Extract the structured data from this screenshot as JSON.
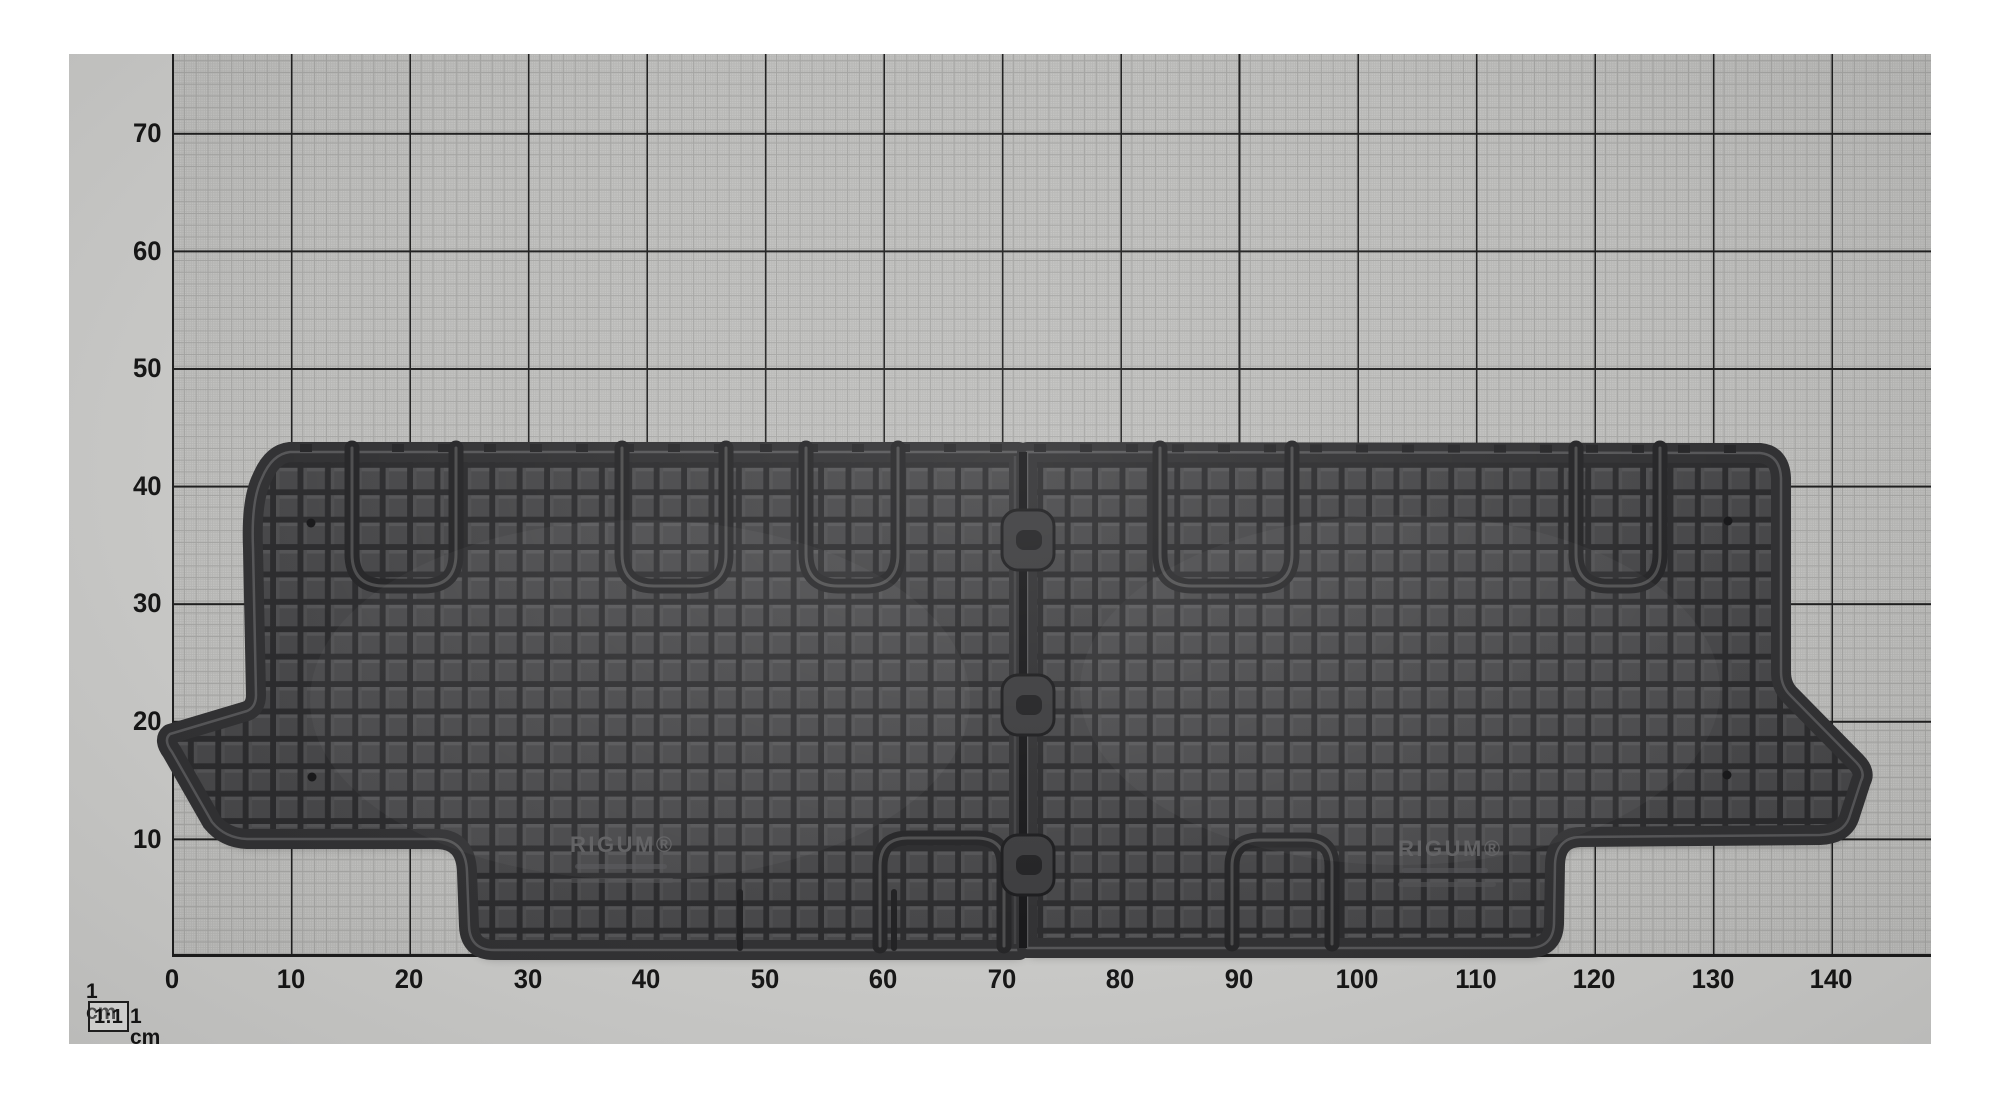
{
  "meta": {
    "description": "Black rubber third-row car floor mat (two hinged pieces) photographed on 1 cm measuring grid paper",
    "brand": "RIGUM®"
  },
  "ruler": {
    "x_axis_labels": [
      "0",
      "10",
      "20",
      "30",
      "40",
      "50",
      "60",
      "70",
      "80",
      "90",
      "100",
      "110",
      "120",
      "130",
      "140"
    ],
    "y_axis_labels": [
      "70",
      "60",
      "50",
      "40",
      "30",
      "20",
      "10"
    ],
    "unit_note_top": "1 cm",
    "scale_ratio": "1:1",
    "unit_note_bottom": "1 cm"
  },
  "mat": {
    "brand_left": "RIGUM®",
    "brand_right": "RIGUM®"
  },
  "colors": {
    "page_background": "#ffffff",
    "paper_margin": "#c9c9c7",
    "grid_paper": "#c2c2c0",
    "grid_line_fine": "#a3a3a1",
    "grid_line_bold": "#1d1d1d",
    "axis_text": "#141414",
    "mat_base": "#454547",
    "mat_groove": "#29292b",
    "mat_rim": "#2f2f31",
    "mat_highlight": "#606062"
  }
}
